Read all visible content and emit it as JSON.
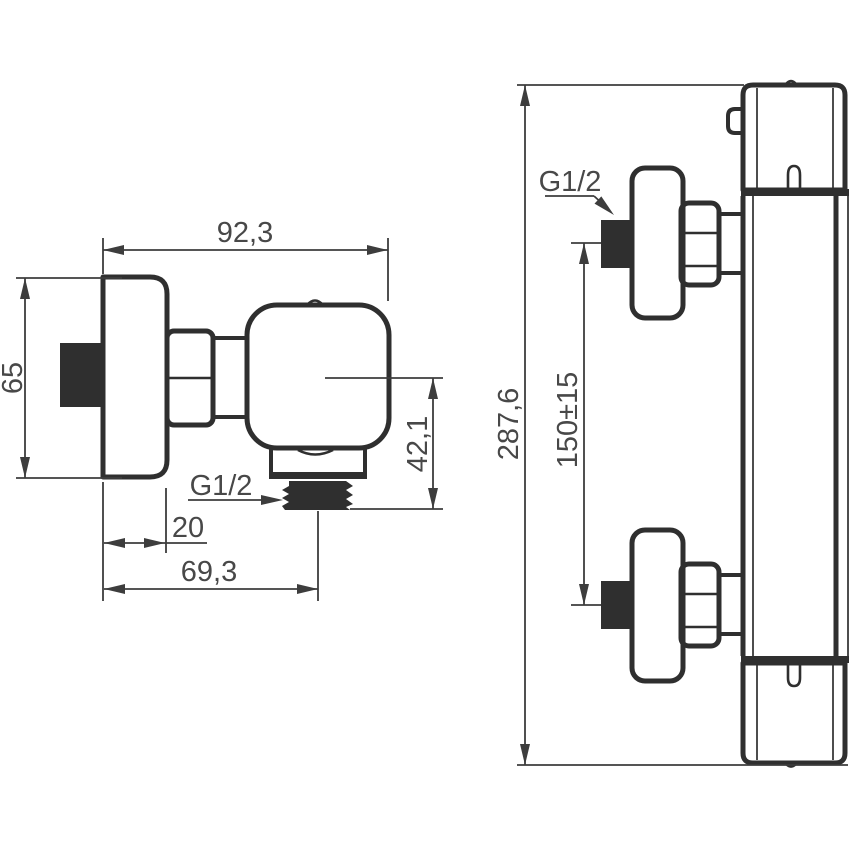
{
  "title": "Shower mixer dimensional drawing",
  "colors": {
    "bg": "#ffffff",
    "ink": "#2f2f2f",
    "dimc": "#3d3d3d",
    "textc": "#484848"
  },
  "views": {
    "side": {
      "labels": {
        "overall_width": "92,3",
        "height": "65",
        "outlet_drop": "42,1",
        "plate_depth": "20",
        "outlet_offset": "69,3",
        "thread": "G1/2"
      }
    },
    "front": {
      "labels": {
        "overall_height": "287,6",
        "connection_spacing": "150±15",
        "thread": "G1/2"
      }
    }
  }
}
